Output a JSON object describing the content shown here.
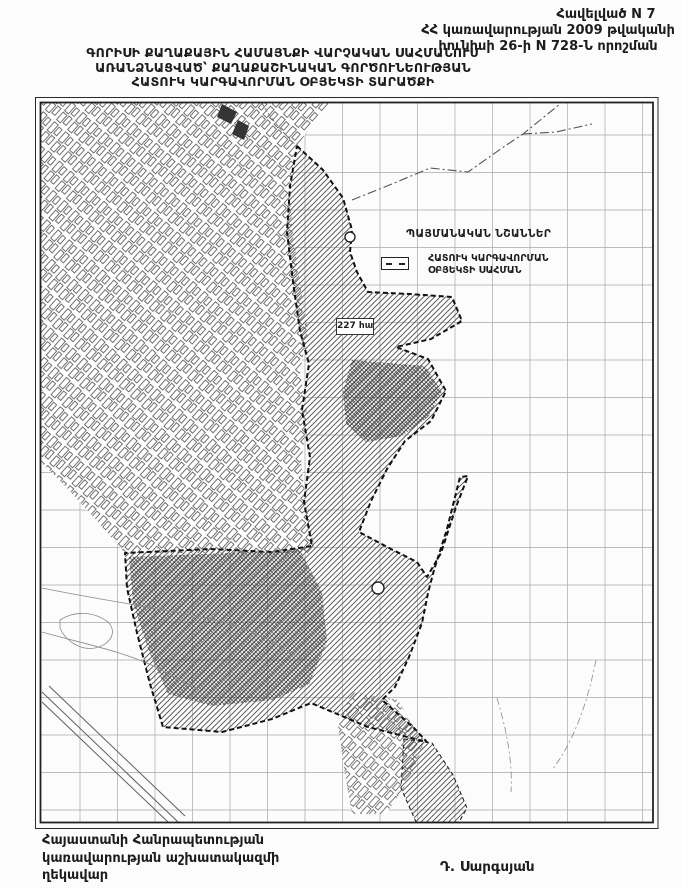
{
  "document": {
    "appendix": {
      "line1": "Հավելված N 7",
      "line2": "ՀՀ կառավարության 2009 թվականի",
      "line3": "հունիսի 26-ի N 728-Ն որոշման"
    },
    "title": {
      "line1": "ԳՈՐԻՍԻ ՔԱՂԱՔԱՅԻՆ ՀԱՄԱՅՆՔԻ ՎԱՐՉԱԿԱՆ ՍԱՀՄԱՆՈՒՄ",
      "line2": "ԱՌԱՆՁՆԱՑՎԱԾ՝ ՔԱՂԱՔԱՇԻՆԱԿԱՆ ԳՈՐԾՈՒՆԵՈՒԹՅԱՆ",
      "line3": "ՀԱՏՈՒԿ ԿԱՐԳԱՎՈՐՄԱՆ ՕԲՅԵԿՏԻ ՏԱՐԱԾՔԻ"
    },
    "footer": {
      "line1": "Հայաստանի Հանրապետության",
      "line2": "կառավարության աշխատակազմի",
      "line3": "ղեկավար",
      "signature": "Դ. Սարգսյան"
    }
  },
  "map": {
    "legend": {
      "title": "ՊԱՅՄԱՆԱԿԱՆ ՆՇԱՆՆԵՐ",
      "entry_line1": "ՀԱՏՈՒԿ ԿԱՐԳԱՎՈՐՄԱՆ",
      "entry_line2": "ՕԲՅԵԿՏԻ ՍԱՀՄԱՆ",
      "symbol": "dashed-boundary-rectangle"
    },
    "area_label": "227 հա",
    "colors": {
      "ink": "#1f1f1f",
      "hatch": "#4d4d4d",
      "grid": "#9a9a9a",
      "frame": "#2b2b2b"
    }
  }
}
